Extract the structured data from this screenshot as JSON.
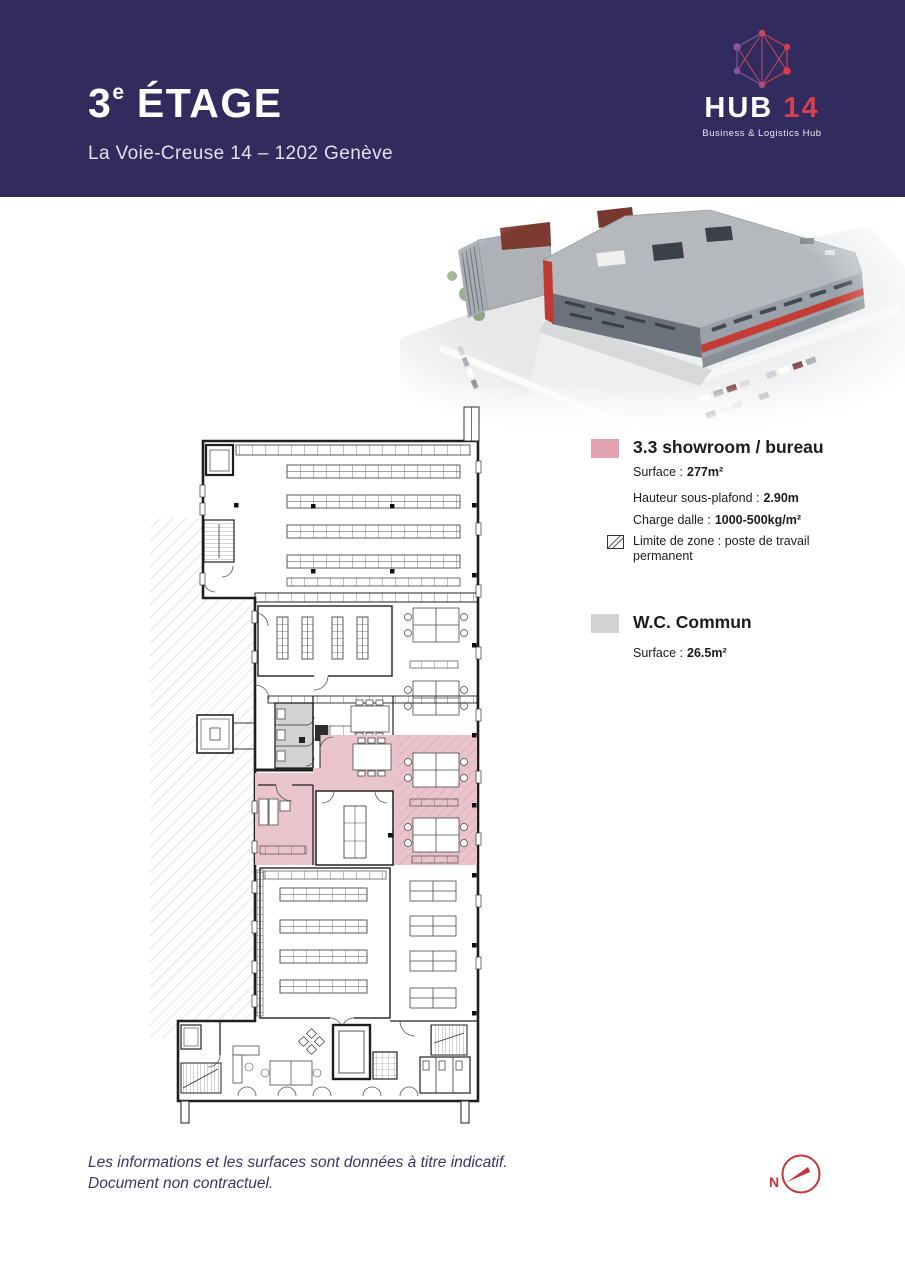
{
  "header": {
    "floor_number": "3",
    "floor_ordinal": "e",
    "floor_word": " ÉTAGE",
    "address": "La Voie-Creuse 14 – 1202 Genève"
  },
  "logo": {
    "brand": "HUB",
    "number": "14",
    "tagline": "Business & Logistics Hub"
  },
  "legend": {
    "zones": [
      {
        "title": "3.3 showroom / bureau",
        "details": [
          {
            "label": "Surface :",
            "value": "277m²"
          },
          {
            "label": "Hauteur sous-plafond :",
            "value": "2.90m"
          },
          {
            "label": "Charge dalle :",
            "value": "1000-500kg/m²"
          }
        ],
        "hatch_note": "Limite de zone : poste de travail permanent"
      },
      {
        "title": "W.C. Commun",
        "details": [
          {
            "label": "Surface :",
            "value": "26.5m²"
          }
        ]
      }
    ]
  },
  "footer": {
    "line1": "Les informations et les surfaces sont données à titre indicatif.",
    "line2": "Document non contractuel."
  },
  "compass": {
    "north_label": "N"
  },
  "colors": {
    "header_bg": "#312b5e",
    "logo_red": "#d4404e",
    "logo_purple": "#8a56a0",
    "zone_pink": "#eac4cd",
    "zone_pink_hatch": "#d79fae",
    "zone_pink_legend": "#e1a3af",
    "zone_gray": "#d2d2d2",
    "compass_red": "#c4353c",
    "footer_text": "#3b3668"
  }
}
